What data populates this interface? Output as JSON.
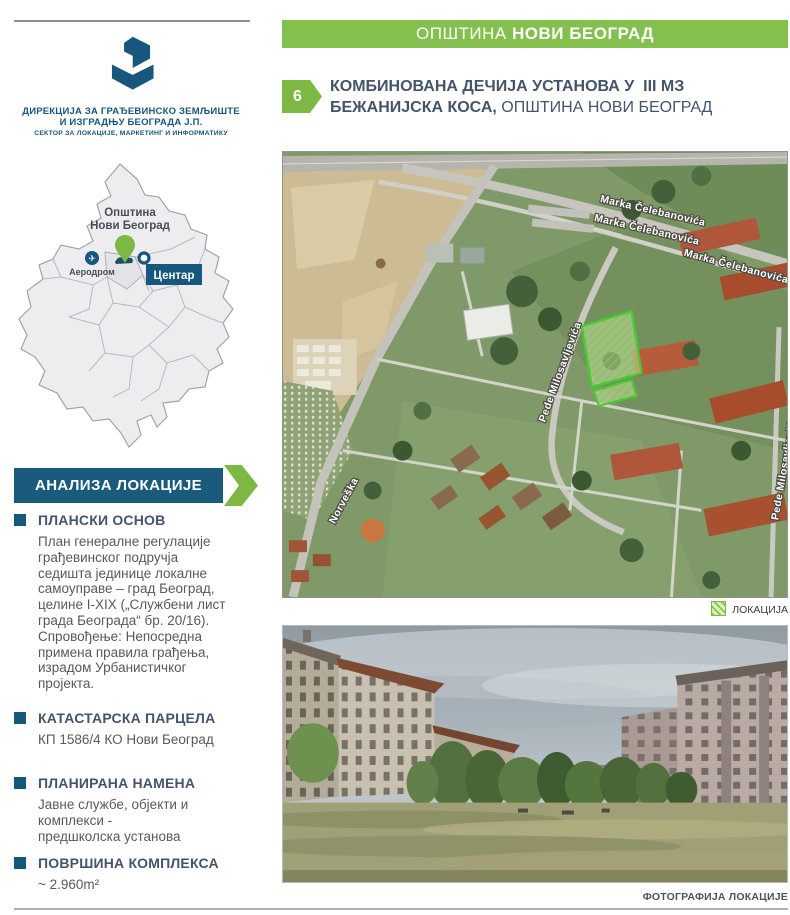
{
  "header": {
    "municipality_prefix": "ОПШТИНА ",
    "municipality_bold": "НОВИ БЕОГРАД",
    "item_number": "6",
    "title_line1": "КОМБИНОВАНА ДЕЧИЈА УСТАНОВА У  III МЗ",
    "title_line2_bold": "БЕЖАНИЈСКА КОСА,",
    "title_line2_regular": " ОПШТИНА НОВИ БЕОГРАД"
  },
  "org": {
    "name_line1": "ДИРЕКЦИЈА ЗА ГРАЂЕВИНСКО ЗЕМЉИШТЕ",
    "name_line2": "И ИЗГРАДЊУ БЕОГРАДА Ј.П.",
    "sector": "СЕКТОР ЗА ЛОКАЦИЈЕ, МАРКЕТИНГ И ИНФОРМАТИКУ"
  },
  "city_map": {
    "municipality_line1": "Општина",
    "municipality_line2": "Нови Београд",
    "airport_label": "Аеродром",
    "center_label": "Центар"
  },
  "analysis": {
    "banner": "АНАЛИЗА ЛОКАЦИЈЕ",
    "sections": [
      {
        "heading": "ПЛАНСКИ ОСНОВ",
        "lines": [
          "План генералне регулације",
          "грађевинског подручја",
          "седишта јединице локалне",
          "самоуправе – град Београд,",
          "целине I-XIX („Службени лист",
          "града Београда“ бр. 20/16).",
          "Спровођење: Непосредна",
          "примена правила грађења,",
          "израдом Урбанистичког",
          "пројекта."
        ]
      },
      {
        "heading": "КАТАСТАРСКА ПАРЦЕЛА",
        "lines": [
          "КП 1586/4 КО Нови Београд"
        ]
      },
      {
        "heading": "ПЛАНИРАНА НАМЕНА",
        "lines": [
          "Јавне службе, објекти и",
          "комплекси -",
          "предшколска установа"
        ]
      },
      {
        "heading": "ПОВРШИНА КОМПЛЕКСА",
        "lines": [
          "~ 2.960m²"
        ]
      }
    ]
  },
  "satellite_map": {
    "street_labels": [
      "Marka Čelebanovića",
      "Marka Čelebanovića",
      "Marka Čelebanovića",
      "Pede Milosavljevića",
      "Pede Milosavljevića",
      "Norveška"
    ],
    "legend_label": "ЛОКАЦИЈА"
  },
  "photo": {
    "caption": "ФОТОГРАФИЈА ЛОКАЦИЈЕ"
  },
  "colors": {
    "accent_green": "#84c04e",
    "dark_blue": "#1a5b7d",
    "heading_text": "#44546a",
    "body_text": "#595959",
    "location_outline": "#46cc30"
  }
}
